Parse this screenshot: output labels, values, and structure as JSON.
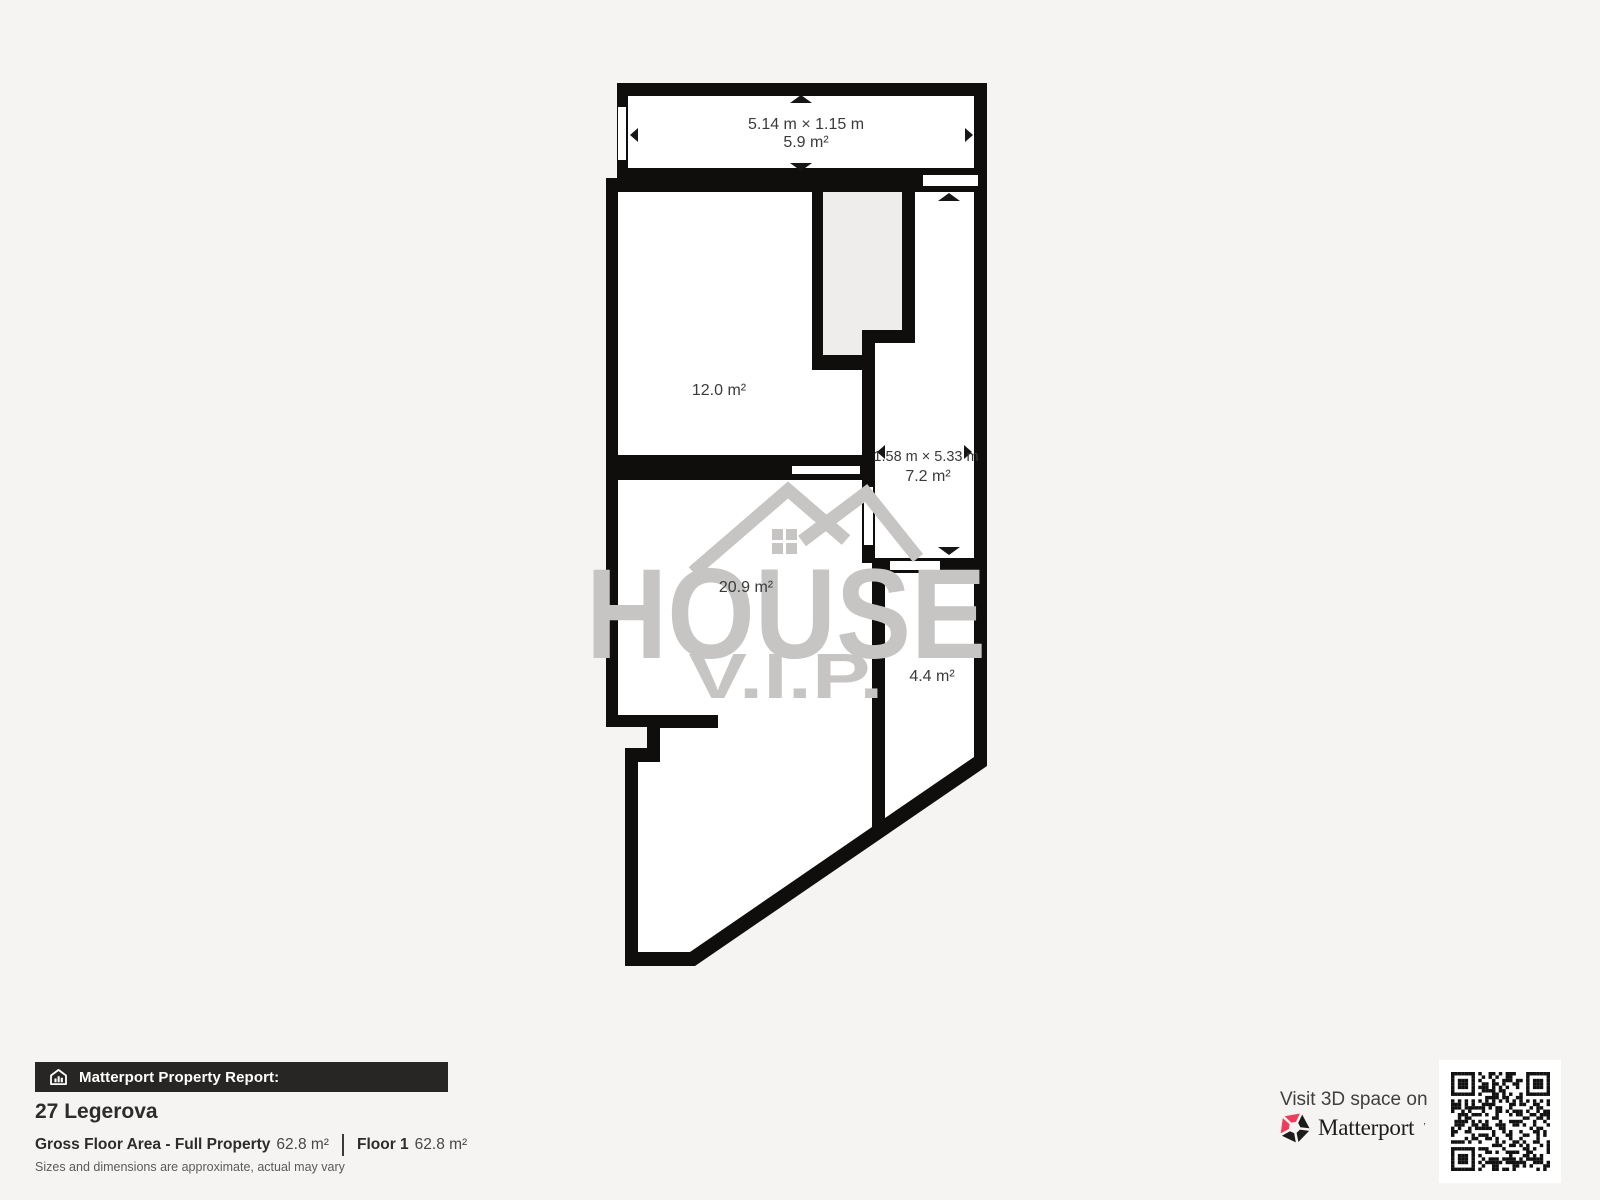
{
  "plan": {
    "rooms": {
      "balcony": {
        "dimensions": "5.14 m × 1.15 m",
        "area": "5.9 m²"
      },
      "room_12": {
        "area": "12.0 m²"
      },
      "corridor": {
        "dimensions": "1.58 m × 5.33 m",
        "area": "7.2 m²"
      },
      "room_20": {
        "area": "20.9 m²"
      },
      "room_4": {
        "area": "4.4 m²"
      }
    },
    "colors": {
      "wall": "#0f0e0c",
      "interior": "#ffffff",
      "alcove": "#efedeb",
      "background": "#f5f4f2",
      "label": "#3a3a3a",
      "watermark": "#c6c5c4"
    }
  },
  "watermark": {
    "line1": "HOUSE",
    "line2": "V.I.P."
  },
  "footer": {
    "report_label": "Matterport Property Report:",
    "address": "27 Legerova",
    "gfa_label": "Gross Floor Area - Full Property",
    "gfa_value": "62.8 m²",
    "floor_label": "Floor 1",
    "floor_value": "62.8 m²",
    "disclaimer": "Sizes and dimensions are approximate, actual may vary"
  },
  "matterport": {
    "visit_text": "Visit 3D space on",
    "brand": "Matterport",
    "accent": "#ee3d5c"
  }
}
